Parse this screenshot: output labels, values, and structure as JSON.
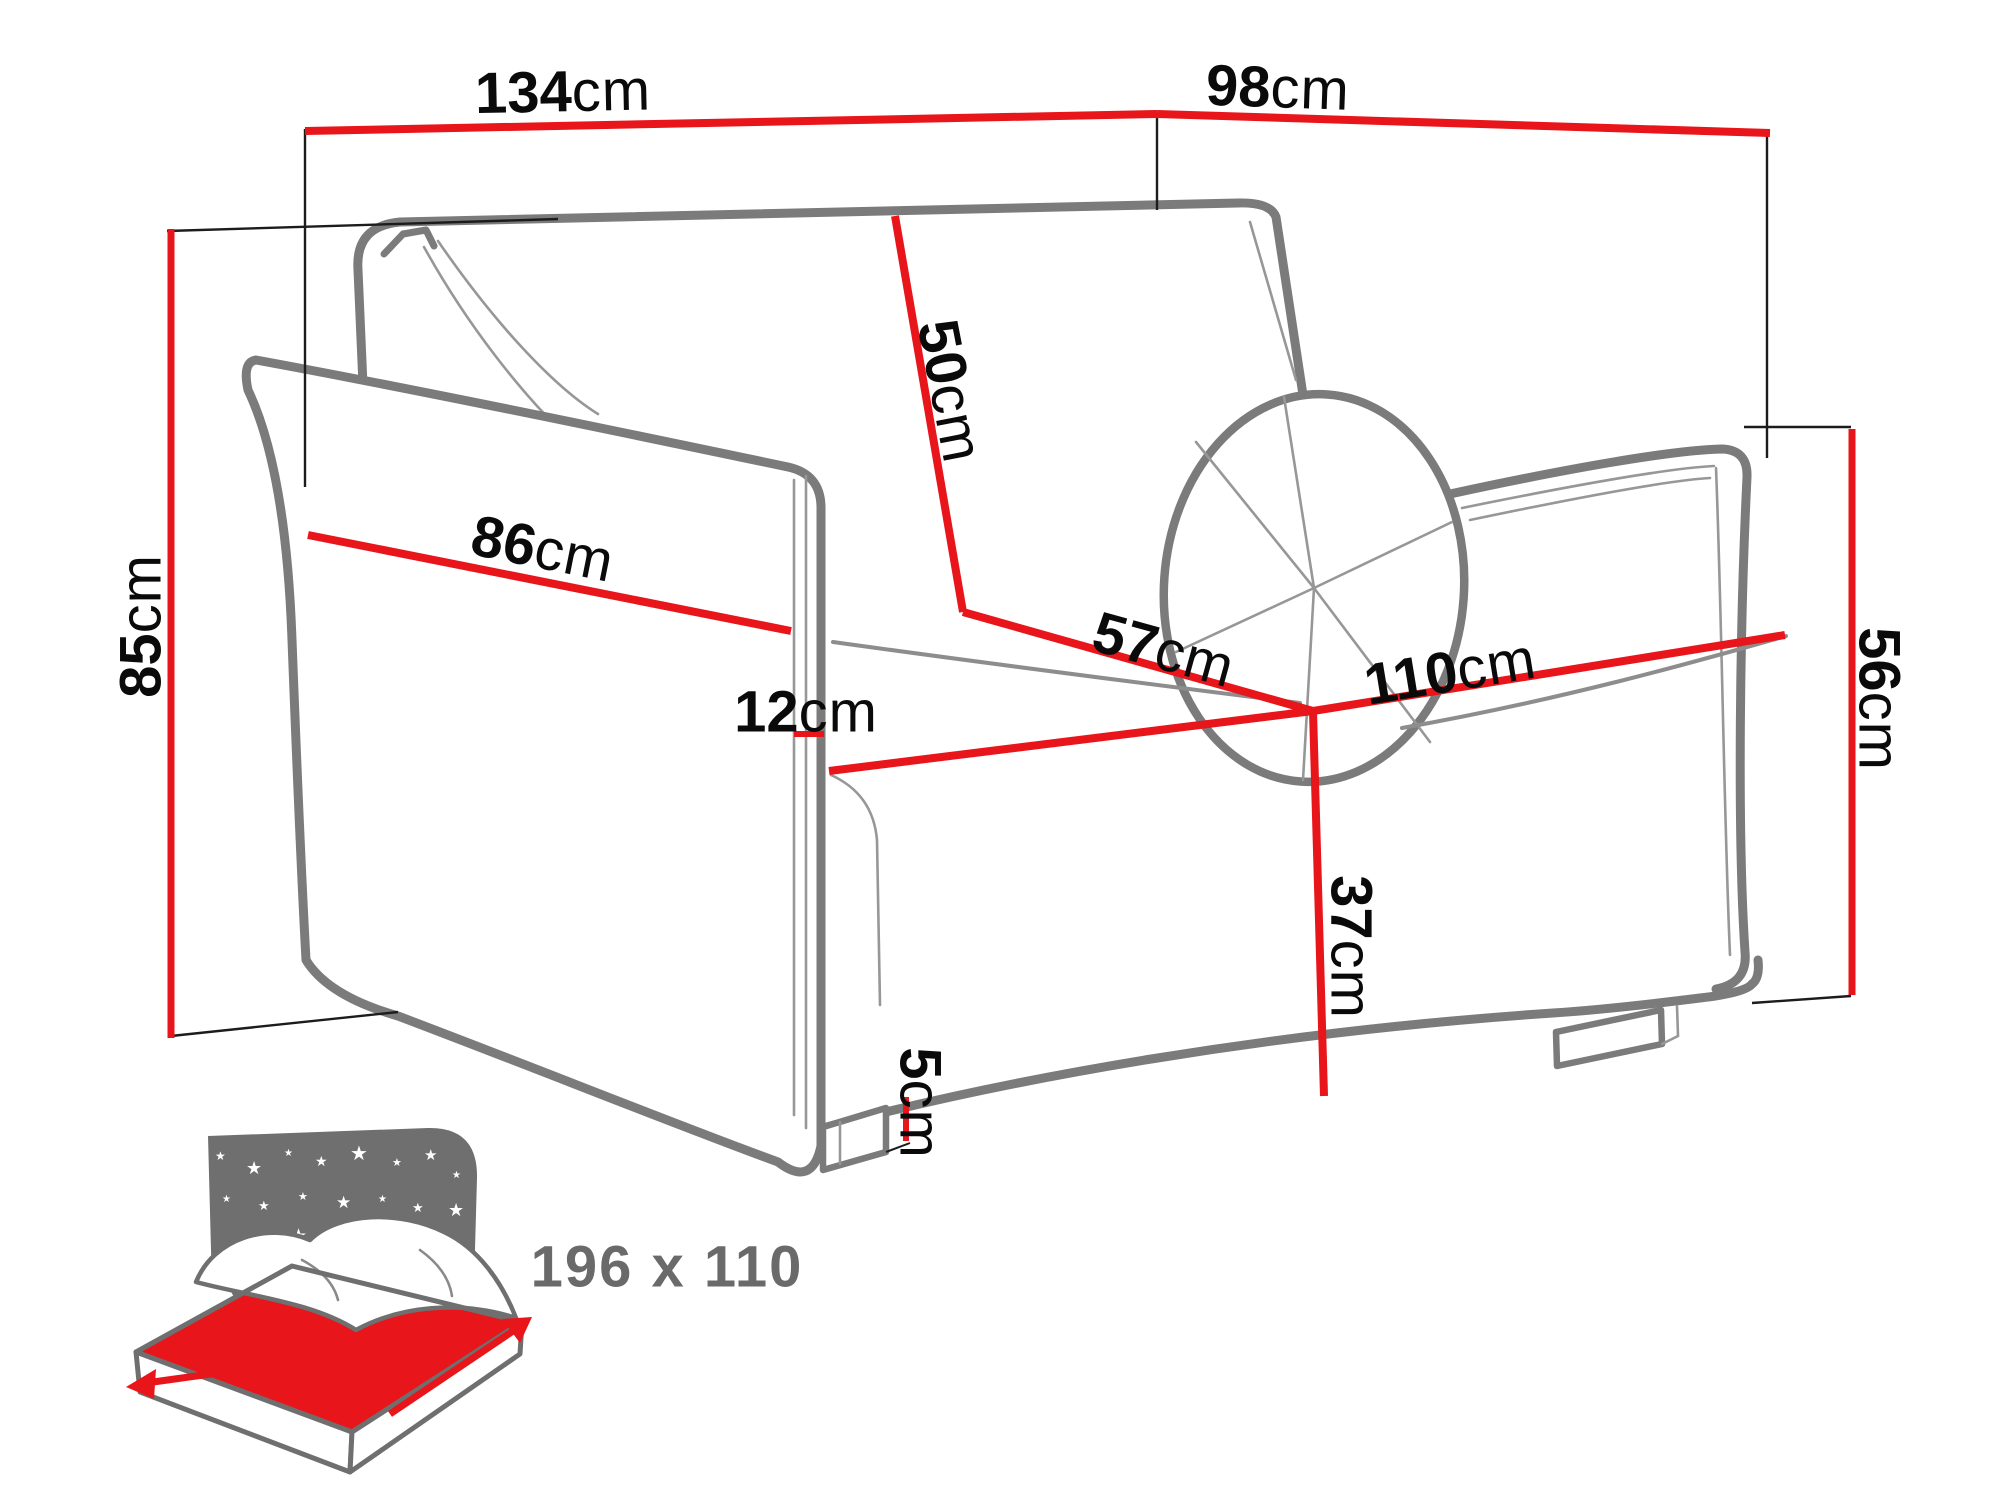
{
  "diagram_title": "sofa-bed-dimension-diagram",
  "dimensions": {
    "overall_width": {
      "value": "134",
      "unit": "cm"
    },
    "overall_depth": {
      "value": "98",
      "unit": "cm"
    },
    "overall_height": {
      "value": "85",
      "unit": "cm"
    },
    "armrest_length": {
      "value": "86",
      "unit": "cm"
    },
    "armrest_width": {
      "value": "12",
      "unit": "cm"
    },
    "backrest_height": {
      "value": "50",
      "unit": "cm"
    },
    "seat_depth": {
      "value": "57",
      "unit": "cm"
    },
    "seat_width": {
      "value": "110",
      "unit": "cm"
    },
    "seat_height": {
      "value": "37",
      "unit": "cm"
    },
    "floor_clearance": {
      "value": "5",
      "unit": "cm"
    },
    "side_height": {
      "value": "56",
      "unit": "cm"
    }
  },
  "sleeping_area": {
    "icon": "bed-with-night-sky-icon",
    "size_label": "196 x 110"
  },
  "colors": {
    "dimension_red": "#e8151b",
    "sofa_outline_gray": "#7b7b7b",
    "icon_gray": "#6f6f6f",
    "icon_text_gray": "#6a6a6a",
    "label_black": "#0a0a0a",
    "background": "#ffffff"
  }
}
